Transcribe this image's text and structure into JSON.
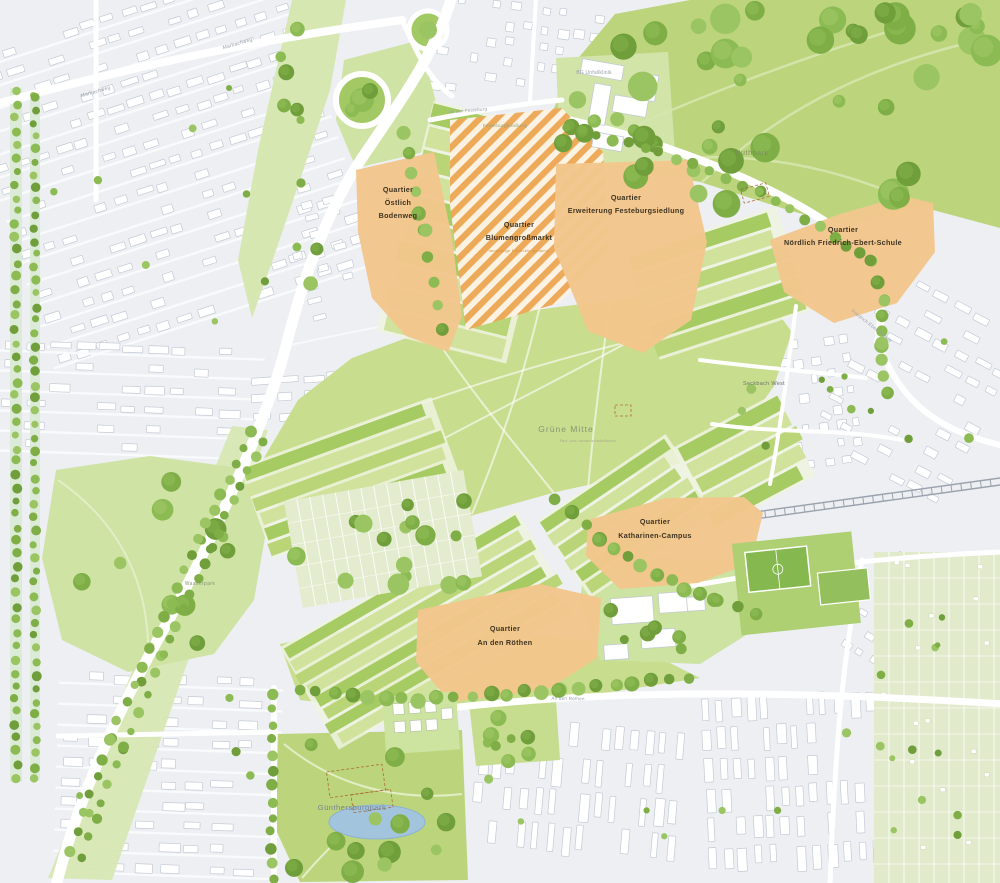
{
  "map": {
    "colors": {
      "urban_bg": "#edeff3",
      "building_fill": "#ffffff",
      "building_stroke": "#c3cad5",
      "street_line": "#f8fafc",
      "road": "#ffffff",
      "quarter_orange": "#f2c68c",
      "hatch_orange": "#eda24a",
      "hatch_bg": "#fdf3e5",
      "park_green": "#bcd57d",
      "park_path": "#d5e5ae",
      "meadow_green": "#c8dd8e",
      "light_green": "#cfe3a4",
      "wedge_green": "#d7e7b2",
      "field_dark": "#a6cb63",
      "field_mid": "#b9d577",
      "field_light": "#d0e29b",
      "allotment": "#e4eccf",
      "allotment_right": "#e2eacc",
      "water": "#a2c4dd",
      "water_stroke": "#8db3cf",
      "rail": "#9aa2ad",
      "pitch_green": "#85b84f",
      "construction_dash": "#a85c28",
      "label_dark": "#3f3320",
      "label_sub_orange": "#cf9445",
      "label_park": "#7f8e64",
      "label_street": "#9aa0ab",
      "tree_palette": [
        "#6f9e3b",
        "#7fae47",
        "#8cbb53",
        "#9bc562",
        "#5f8c31"
      ]
    },
    "quarters": [
      {
        "id": "oestlich-bodenweg",
        "lines": [
          "Quartier",
          "Östlich",
          "Bodenweg"
        ],
        "style": "solid",
        "polygon": [
          [
            356,
            170
          ],
          [
            434,
            152
          ],
          [
            452,
            238
          ],
          [
            462,
            316
          ],
          [
            448,
            352
          ],
          [
            406,
            336
          ],
          [
            372,
            298
          ],
          [
            358,
            232
          ]
        ],
        "label": {
          "x": 398,
          "y": 192,
          "lh": 13
        }
      },
      {
        "id": "blumengrossmarkt",
        "lines": [
          "Quartier",
          "Blumengroßmarkt"
        ],
        "sub": "langfristige Entwicklungsfläche",
        "style": "hatched",
        "polygon": [
          [
            450,
            120
          ],
          [
            562,
            108
          ],
          [
            603,
            152
          ],
          [
            609,
            255
          ],
          [
            559,
            303
          ],
          [
            466,
            330
          ],
          [
            450,
            205
          ]
        ],
        "label": {
          "x": 519,
          "y": 227,
          "lh": 13,
          "subdy": 12
        }
      },
      {
        "id": "erweiterung-festeburgsiedlung",
        "lines": [
          "Quartier",
          "Erweiterung Festeburgsiedlung"
        ],
        "style": "solid",
        "polygon": [
          [
            556,
            164
          ],
          [
            688,
            160
          ],
          [
            707,
            242
          ],
          [
            691,
            320
          ],
          [
            643,
            353
          ],
          [
            588,
            331
          ],
          [
            554,
            248
          ]
        ],
        "label": {
          "x": 626,
          "y": 200,
          "lh": 13
        }
      },
      {
        "id": "noerdlich-friedrich-ebert-schule",
        "lines": [
          "Quartier",
          "Nördlich Friedrich-Ebert-Schule"
        ],
        "style": "solid",
        "polygon": [
          [
            770,
            240
          ],
          [
            840,
            214
          ],
          [
            903,
            196
          ],
          [
            933,
            203
          ],
          [
            935,
            252
          ],
          [
            897,
            303
          ],
          [
            834,
            323
          ],
          [
            784,
            292
          ]
        ],
        "label": {
          "x": 843,
          "y": 232,
          "lh": 13
        }
      },
      {
        "id": "katharinen-campus",
        "lines": [
          "Quartier",
          "Katharinen-Campus"
        ],
        "style": "solid",
        "polygon": [
          [
            588,
            520
          ],
          [
            666,
            498
          ],
          [
            744,
            497
          ],
          [
            763,
            513
          ],
          [
            751,
            563
          ],
          [
            698,
            583
          ],
          [
            620,
            589
          ],
          [
            586,
            556
          ]
        ],
        "label": {
          "x": 655,
          "y": 524,
          "lh": 14
        }
      },
      {
        "id": "an-den-roethen",
        "lines": [
          "Quartier",
          "An den Röthen"
        ],
        "style": "solid",
        "polygon": [
          [
            418,
            610
          ],
          [
            540,
            584
          ],
          [
            601,
            598
          ],
          [
            597,
            658
          ],
          [
            547,
            690
          ],
          [
            450,
            702
          ],
          [
            416,
            662
          ]
        ],
        "label": {
          "x": 505,
          "y": 631,
          "lh": 14
        }
      }
    ],
    "area_labels": [
      {
        "id": "huthpark",
        "text": "Huthpark",
        "x": 752,
        "y": 155,
        "size": 7,
        "color": "#7f8e64",
        "ls": 0.6
      },
      {
        "id": "gruene-mitte",
        "text": "Grüne Mitte",
        "x": 566,
        "y": 432,
        "size": 8.5,
        "color": "#8a9574",
        "ls": 1
      },
      {
        "id": "gruene-mitte-sub",
        "text": "Park- und Landwirtschaftsflächen",
        "x": 588,
        "y": 442,
        "size": 3.4,
        "color": "#a9ab8b",
        "ls": 0.2
      },
      {
        "id": "guenthersburgpark",
        "text": "Günthersburgpark",
        "x": 352,
        "y": 810,
        "size": 7.5,
        "color": "#77828e",
        "ls": 0.5
      },
      {
        "id": "wasserpark",
        "text": "Wasserpark",
        "x": 200,
        "y": 585,
        "size": 5,
        "color": "#8a9574",
        "ls": 0.4
      },
      {
        "id": "festeburgsiedlung",
        "text": "Festeburgsiedlung",
        "x": 505,
        "y": 127,
        "size": 4.8,
        "color": "#99a17f",
        "ls": 0.3
      },
      {
        "id": "seckbach-west",
        "text": "Seckbach West",
        "x": 764,
        "y": 385,
        "size": 5.5,
        "color": "#6f7468",
        "ls": 0.3
      }
    ],
    "street_labels": [
      {
        "text": "Marbachweg",
        "x": 96,
        "y": 93,
        "rot": -16,
        "size": 5
      },
      {
        "text": "Marbachweg",
        "x": 238,
        "y": 45,
        "rot": -16,
        "size": 5
      },
      {
        "text": "An der Festeburg",
        "x": 468,
        "y": 112,
        "rot": -5,
        "size": 4.6
      },
      {
        "text": "BG Unfallklinik",
        "x": 594,
        "y": 74,
        "rot": 0,
        "size": 5
      },
      {
        "text": "Friedrich-Ebert-Schule",
        "x": 871,
        "y": 327,
        "rot": 38,
        "size": 4.6
      },
      {
        "text": "An den Röthen",
        "x": 568,
        "y": 700,
        "rot": 1,
        "size": 4.6
      }
    ]
  }
}
